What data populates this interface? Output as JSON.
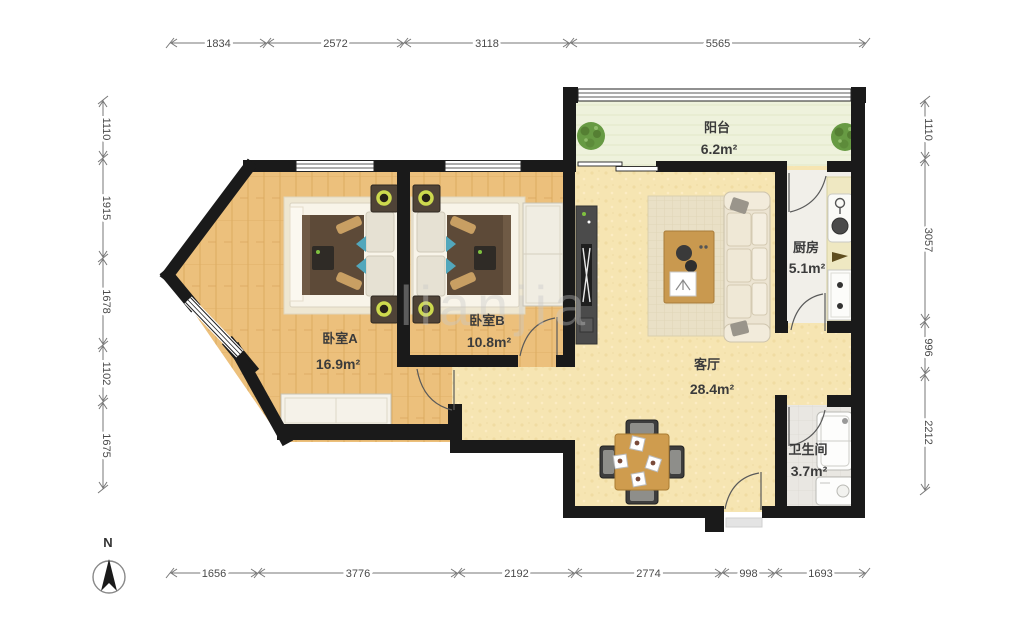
{
  "title": "apartment-floor-plan",
  "watermark": "lianjia",
  "compass": {
    "label": "N"
  },
  "rooms": [
    {
      "id": "bedroom-a",
      "name": "卧室A",
      "area": "16.9m²"
    },
    {
      "id": "bedroom-b",
      "name": "卧室B",
      "area": "10.8m²"
    },
    {
      "id": "living",
      "name": "客厅",
      "area": "28.4m²"
    },
    {
      "id": "kitchen",
      "name": "厨房",
      "area": "5.1m²"
    },
    {
      "id": "bathroom",
      "name": "卫生间",
      "area": "3.7m²"
    },
    {
      "id": "balcony",
      "name": "阳台",
      "area": "6.2m²"
    }
  ],
  "dimensions": {
    "top": [
      "1834",
      "2572",
      "3118",
      "5565"
    ],
    "bottom": [
      "1656",
      "3776",
      "2192",
      "2774",
      "998",
      "1693"
    ],
    "left": [
      "1110",
      "1915",
      "1678",
      "1102",
      "1675"
    ],
    "right": [
      "1110",
      "3057",
      "996",
      "2212"
    ]
  },
  "colors": {
    "wall": "#1a1a1a",
    "wood_floor": "#ecc07c",
    "living_floor": "#f6e5b2",
    "balcony_floor": "#eef2dc",
    "kitchen_floor": "#f1efe9",
    "bath_floor": "#e9e7e2",
    "accent_teal": "#52a7bc",
    "plant_green": "#679a43",
    "dimension_line": "#777777"
  }
}
